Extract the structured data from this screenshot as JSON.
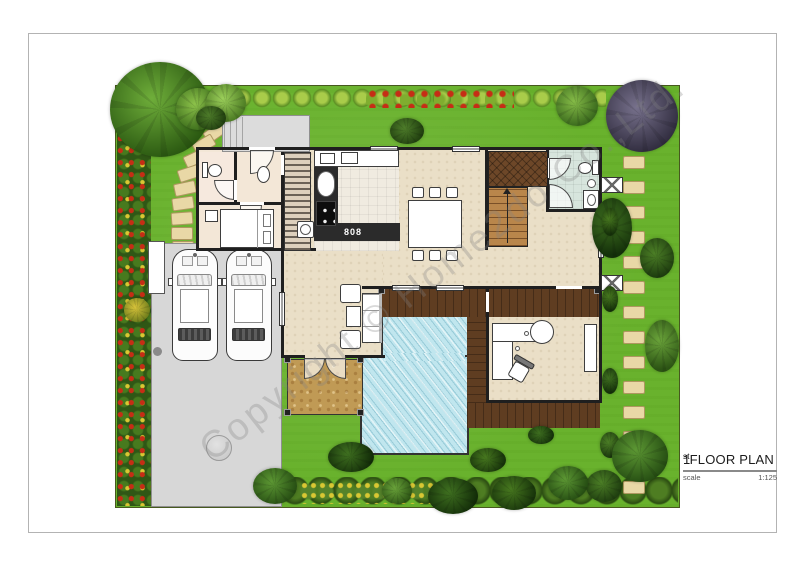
{
  "title_block": {
    "number": "1",
    "ordinal": "st",
    "title": " FLOOR PLAN",
    "scale_label": "scale",
    "scale_value": "1:125"
  },
  "watermark": {
    "text": "Copyright © Home2do Co.,Ltd."
  },
  "kitchen": {
    "cooktop_label": "808"
  },
  "colors": {
    "lawn": "#69b22d",
    "hedge": "#2f5715",
    "hedge_light": "#a9cc4a",
    "flower_red": "#c62d15",
    "flower_yellow": "#d9c733",
    "stone": "#e9d8a6",
    "driveway": "#d7d7d7",
    "wall": "#1f1f1f",
    "floor": "#eadfc7",
    "floor_left": "#f3e7d7",
    "floor_kitchen": "#f0ebe0",
    "floor_bath": "#d7e5dd",
    "pool": "#c0e6ee",
    "deck": "#5f3d21",
    "deck_entry": "#6d4728",
    "stair": "#b9864b",
    "terrace": "#c09a55",
    "porch": "#dcdcdc",
    "title": "#1c1c1c"
  },
  "icons": {
    "tree-icon": "gradient circle",
    "shrub-icon": "gradient circle",
    "stepping-stone-icon": "rounded tan rect",
    "car-icon": "top-view rounded rect",
    "toilet-icon": "tank rect + bowl ellipse",
    "sink-icon": "ellipse basin",
    "bed-icon": "rect with pillows",
    "sofa-icon": "bordered rect with cushions",
    "armchair-icon": "small bordered square",
    "coffee-table-icon": "small rect",
    "dining-table-icon": "rect with chairs",
    "stairs-icon": "treaded rect with up arrow",
    "door-swing-icon": "quarter-circle arc",
    "shower-door-icon": "quarter-circle arc",
    "ac-unit-icon": "white rect with X",
    "washing-machine-icon": "square with drum circle",
    "stove-icon": "dark rect with burner dots",
    "bar-counter-icon": "L counter with round end",
    "office-chair-icon": "rotated seat with back",
    "manhole-icon": "gray circle",
    "gate-icon": "white rect panel",
    "window-icon": "white rect with mullion line",
    "pool-icon": "striped blue rect",
    "deck-icon": "planked brown band"
  }
}
